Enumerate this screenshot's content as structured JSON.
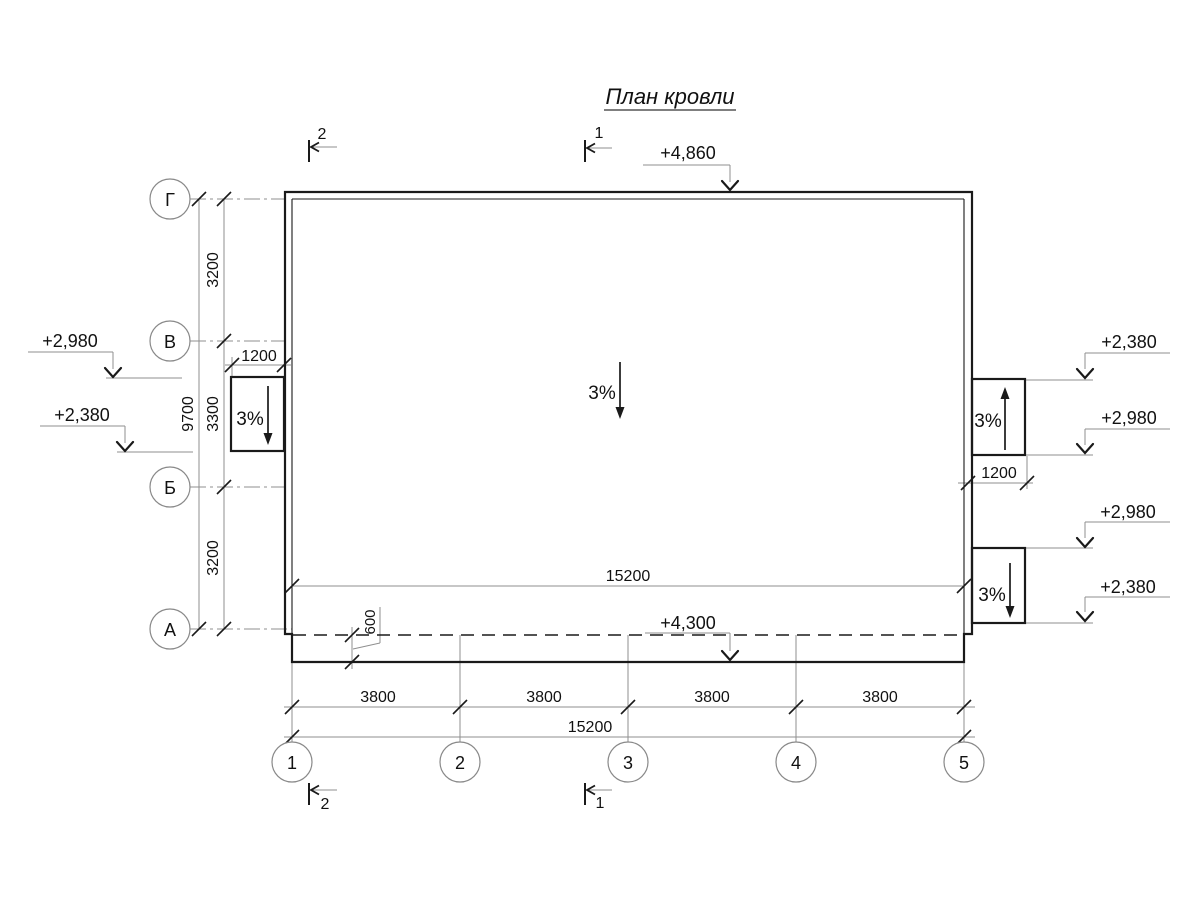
{
  "title": "План кровли",
  "colors": {
    "line": "#1a1a1a",
    "aux": "#8f8f8f",
    "background": "#ffffff"
  },
  "axes": {
    "rows": [
      "Г",
      "В",
      "Б",
      "А"
    ],
    "cols": [
      "1",
      "2",
      "3",
      "4",
      "5"
    ]
  },
  "section_marks": {
    "top_left": "2",
    "top_center": "1",
    "bottom_left": "2",
    "bottom_center": "1"
  },
  "elevations": {
    "roof_top": "+4,860",
    "canopy_edge": "+4,300",
    "left_upper": "+2,980",
    "left_lower": "+2,380",
    "right_1": "+2,380",
    "right_2": "+2,980",
    "right_3": "+2,980",
    "right_4": "+2,380"
  },
  "slopes": {
    "left": "3%",
    "center": "3%",
    "right_upper": "3%",
    "right_lower": "3%"
  },
  "dims": {
    "row_span_top": "3200",
    "row_span_mid": "3300",
    "row_span_bottom": "3200",
    "rows_total": "9700",
    "left_outlet_width": "1200",
    "right_outlet_width": "1200",
    "canopy_width": "600",
    "col_span": "3800",
    "cols_total": "15200",
    "roof_length": "15200"
  }
}
